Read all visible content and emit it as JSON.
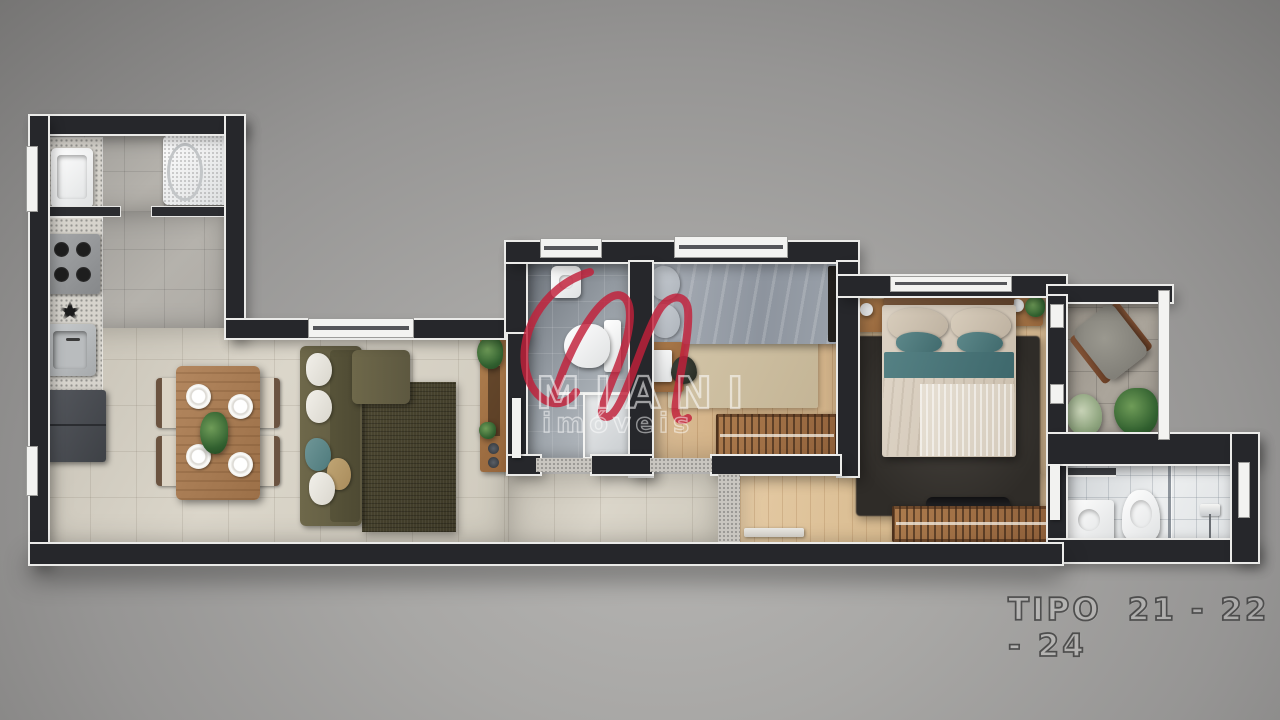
{
  "watermark": {
    "monogram": "M",
    "brand": "MIANI",
    "subtitle": "imóveis",
    "accent_color": "#c2203a",
    "text_color": "#ffffff"
  },
  "plan_label": {
    "type_label": "TIPO",
    "units": "21 - 22 - 24",
    "text_color": "#3e3e3e"
  },
  "palette": {
    "background_gray": "#9a9998",
    "wall_dark": "#26272b",
    "wall_trim_white": "#ebebe9",
    "wood_floor": "#d7b78f",
    "living_tile_beige": "#d6d1c5",
    "kitchen_tile_gray": "#aba9a5",
    "bath_tile_gray": "#99a0a7",
    "bath_tile_white": "#e1e3e5",
    "balcony_tile": "#a59f96",
    "sofa_olive": "#65603f",
    "rug_olive": "#46412c",
    "rug_dark": "#35322e",
    "bed_gray": "#9aa2ac",
    "bed_teal": "#4d7a7e",
    "bed_beige": "#d9cec0",
    "wood_furniture": "#a87e58",
    "accent_red": "#c2203a"
  }
}
